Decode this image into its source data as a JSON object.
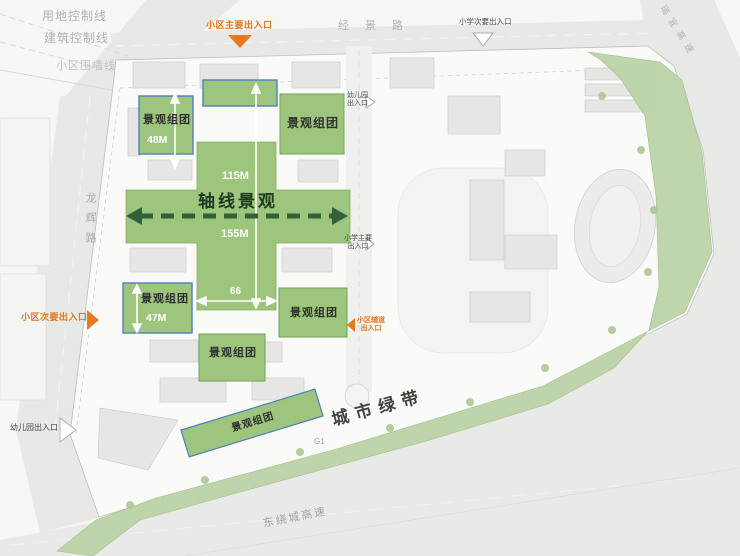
{
  "boundary_labels": {
    "land_control": "用地控制线",
    "building_control": "建筑控制线",
    "community_wall": "小区围墙线"
  },
  "roads": {
    "north": "经景路",
    "northeast": "瑞宜高速",
    "west": "龙辉路",
    "south": "东绕城高速",
    "g1": "G1"
  },
  "green_belt": {
    "label": "城市绿带"
  },
  "axis": {
    "label": "轴线景观",
    "length_upper": "115M",
    "length_lower": "155M",
    "width": "66"
  },
  "clusters": {
    "label": "景观组团",
    "dim_upper_left": "48M",
    "dim_lower_left": "47M"
  },
  "entrances": {
    "community_main": "小区主要出入口",
    "community_secondary": "小区次要出入口",
    "community_service_l1": "小区辅道",
    "community_service_l2": "出入口",
    "school_secondary": "小学次要出入口",
    "school_main_l1": "小学主要",
    "school_main_l2": "出入口",
    "kindergarten_east_l1": "幼儿园",
    "kindergarten_east_l2": "出入口",
    "kindergarten_west": "幼儿园出入口"
  },
  "colors": {
    "cluster_green": "#9dc57d",
    "belt_green": "#bcd3a6",
    "box_border_blue": "#4e7fbe",
    "entrance_orange": "#e8791e",
    "axis_arrow_green": "#31603a"
  }
}
